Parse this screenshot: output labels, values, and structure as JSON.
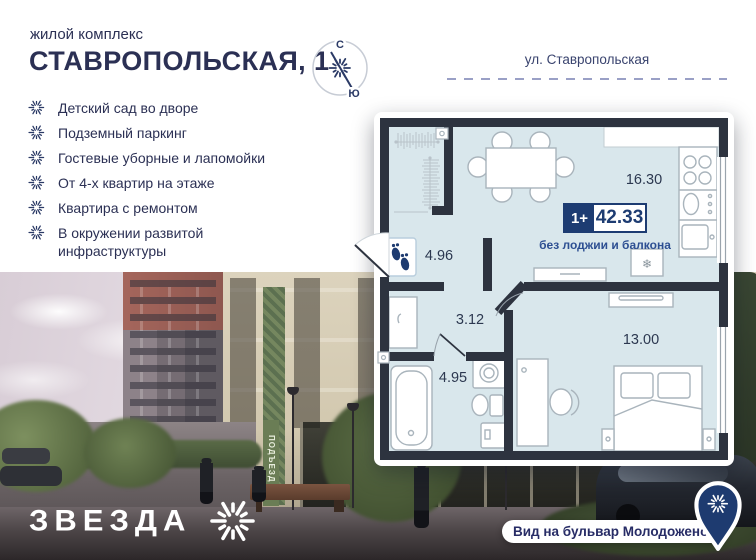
{
  "header": {
    "subtitle": "жилой комплекс",
    "title": "СТАВРОПОЛЬСКАЯ, 1",
    "street": "ул. Ставропольская"
  },
  "compass": {
    "north": "С",
    "south": "Ю"
  },
  "features": {
    "items": [
      "Детский сад во дворе",
      "Подземный паркинг",
      "Гостевые уборные и лапомойки",
      "От 4-х квартир на этаже",
      "Квартира с ремонтом",
      "В окружении развитой инфраструктуры"
    ]
  },
  "floorplan": {
    "badge": {
      "rooms": "1+",
      "area": "42.33"
    },
    "note": "без лоджии и балкона",
    "areas": {
      "kitchen_living": "16.30",
      "hallway": "4.96",
      "hall": "3.12",
      "bathroom": "4.95",
      "bedroom": "13.00"
    },
    "fridge_icon": "❄"
  },
  "photo": {
    "entrance_sign": "ПОДЪЕЗД 1"
  },
  "footer": {
    "brand": "ЗВЕЗДА",
    "view_label": "Вид на бульвар Молодоженов"
  },
  "colors": {
    "navy": "#2b3054",
    "badge_navy": "#1d3c72",
    "wall": "#2d333f",
    "floor": "#d9e7ec",
    "note_blue": "#2d4f92"
  }
}
